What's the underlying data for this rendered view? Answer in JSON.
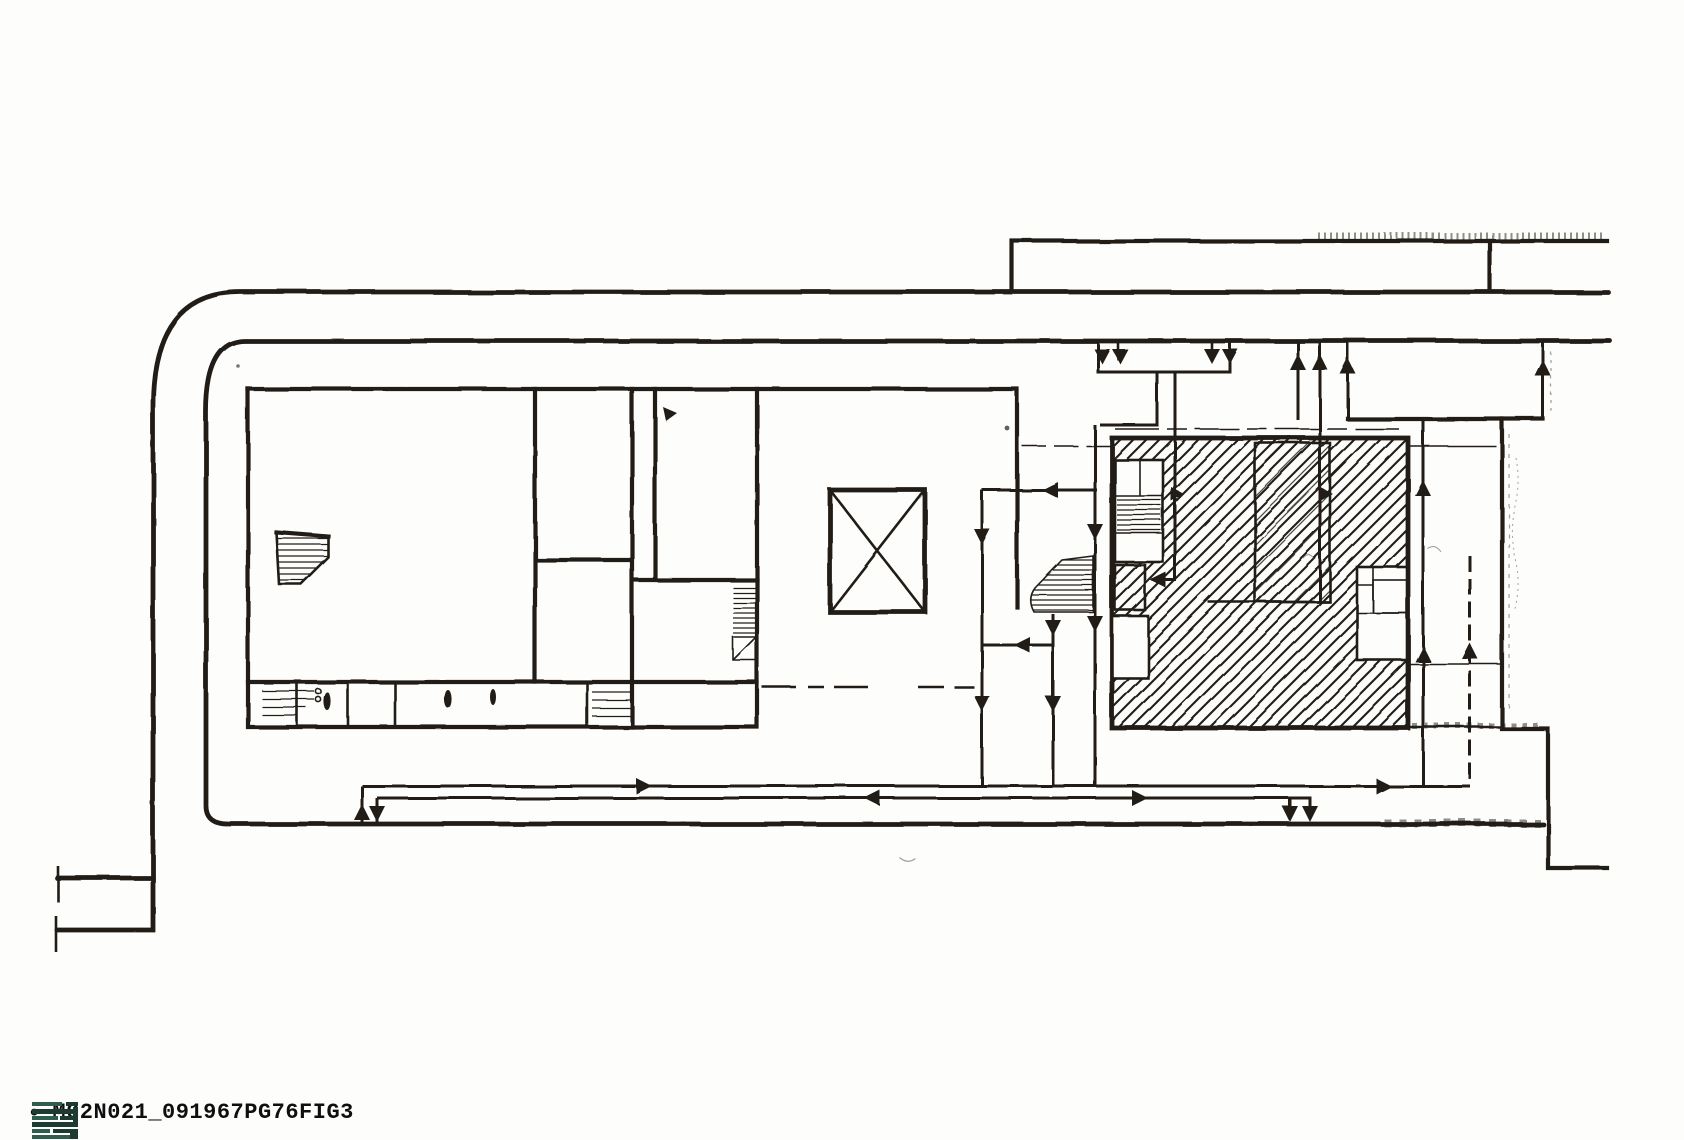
{
  "figure": {
    "bullet": "•",
    "caption": "M02N021_091967PG76FIG3"
  },
  "palette": {
    "paper": "#fdfdfc",
    "ink": "#211d19",
    "ink_light": "#5a554e",
    "logo_teal_dark": "#1d3b33",
    "logo_teal": "#2f5d50",
    "caption_ink": "#0f0f0f"
  },
  "drawing": {
    "kind": "scanned architectural site and circulation plan",
    "regions": {
      "boundary_roads": "double road line wrapping the north and west sides with rounded corner, service lane along the south",
      "north_canopy": "long narrow strip structure above the north road",
      "west_building": "rectangular block with interior rooms, stair, service band of small cells",
      "courtyard": "open court containing a crossed (X) skylight square and dashed datum lines",
      "east_building": "square block filled with diagonal hatching, stair cores and white room cut-outs",
      "circulation": "arrowed flow routes entering from the north road, passing the buildings and along the south lane"
    }
  }
}
